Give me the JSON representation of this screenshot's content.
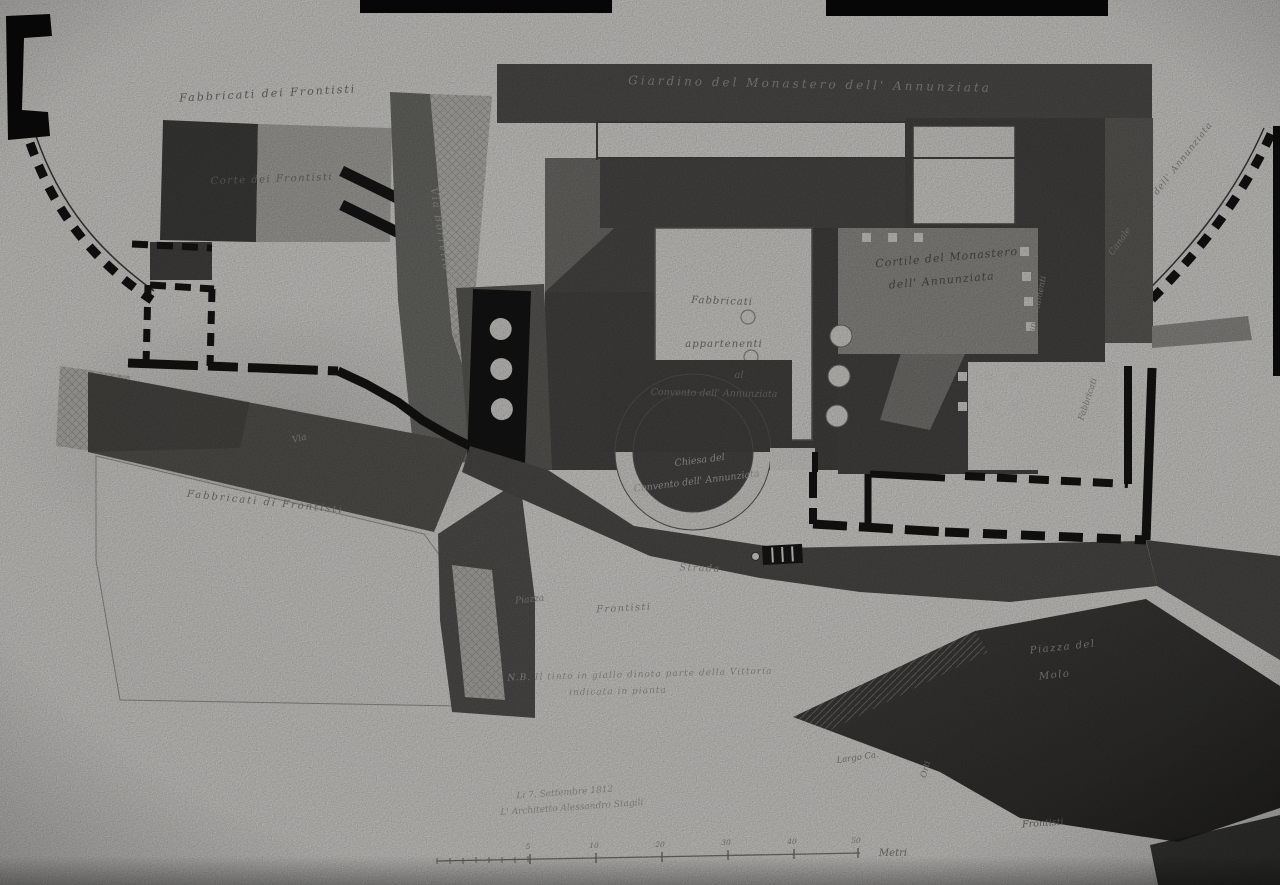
{
  "colors": {
    "paper": "#d8d7d3",
    "ink_walls": "#141413",
    "wash_dark": "#474645",
    "wash_medium": "#8e8d88",
    "photo_backdrop": "#060606"
  },
  "plan": {
    "labels": {
      "block_top_left": "Fabbricati dei Frontisti",
      "court_top_left": "Corte dei Frontisti",
      "garden_band": "Giardino del Monastero dell' Annunziata",
      "street_vertical": "Via Borrello",
      "wall_right_upper": "dell' Annunziata",
      "wall_right_lower": "Canale",
      "cortile_line1": "Cortile del Monastero",
      "cortile_line2": "dell' Annunziata",
      "court_center_line1": "Fabbricati",
      "court_center_line2": "appartenenti",
      "court_center_line3": "al",
      "court_center_line4": "Convento dell' Annunziata",
      "church_line1": "Chiesa del",
      "church_line2": "Convento dell' Annunziata",
      "via_small": "Via",
      "strada": "Strada",
      "piazza_small": "Piazza",
      "frontisti_center": "Frontisti",
      "block_bottom_left": "Fabbricati di Frontisti",
      "appartamenti_vertical": "appartamenti",
      "fabbricato_vertical": "Fabbricati",
      "piazza_molo_line1": "Piazza del",
      "piazza_molo_line2": "Molo",
      "largo_small": "Largo Ca.",
      "orti_vertical": "Orti",
      "frontisti_bottom_right": "Frontisti"
    },
    "note": {
      "line1": "N.B. Il tinto in giallo dinota parte della Vittoria",
      "line2": "indicata in pianta"
    },
    "signature": {
      "line1": "Li 7. Settembre 1812",
      "line2": "L' Architetto Alessandro Stagili"
    },
    "scale_bar": {
      "unit": "Metri",
      "ticks": [
        "5",
        "10",
        "20",
        "30",
        "40",
        "50"
      ]
    }
  }
}
